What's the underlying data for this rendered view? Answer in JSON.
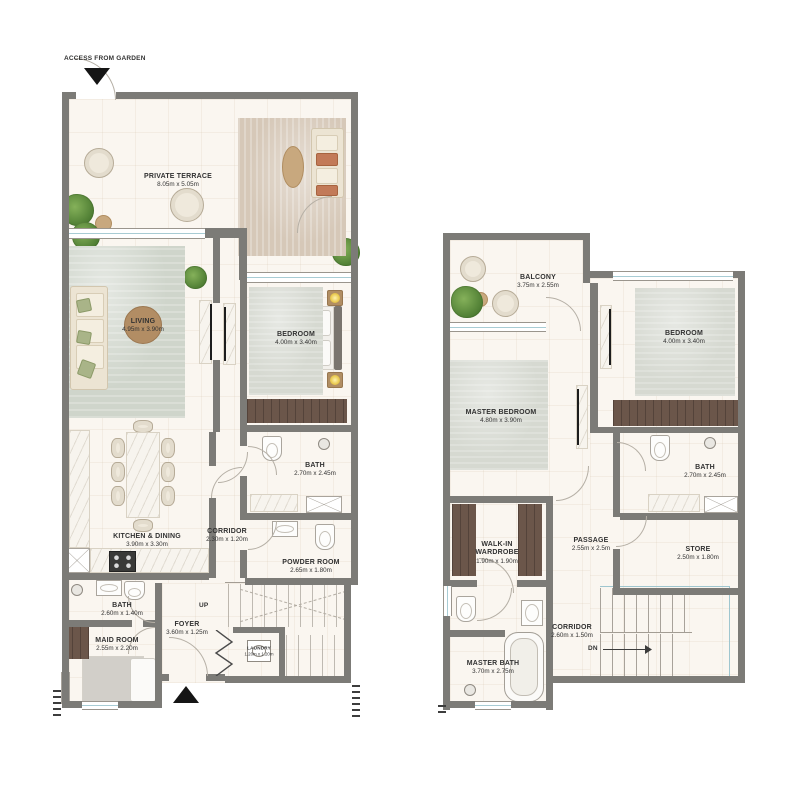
{
  "floor1": {
    "access_label": "ACCESS FROM GARDEN",
    "up_label": "UP",
    "rooms": {
      "terrace": {
        "name": "PRIVATE TERRACE",
        "dims": "8.05m x 5.05m"
      },
      "living": {
        "name": "LIVING",
        "dims": "4.95m x 3.90m"
      },
      "bedroom": {
        "name": "BEDROOM",
        "dims": "4.00m x 3.40m"
      },
      "bath": {
        "name": "BATH",
        "dims": "2.70m x 2.45m"
      },
      "corridor": {
        "name": "CORRIDOR",
        "dims": "2.30m x 1.20m"
      },
      "kitchen": {
        "name": "KITCHEN & DINING",
        "dims": "3.90m x 3.30m"
      },
      "powder": {
        "name": "POWDER ROOM",
        "dims": "2.65m x 1.80m"
      },
      "bath2": {
        "name": "BATH",
        "dims": "2.60m x 1.40m"
      },
      "maid": {
        "name": "MAID ROOM",
        "dims": "2.55m x 2.20m"
      },
      "foyer": {
        "name": "FOYER",
        "dims": "3.60m x 1.25m"
      },
      "laundry": {
        "name": "LAUNDRY",
        "dims": "1.20m x 1.20m"
      }
    }
  },
  "floor2": {
    "dn_label": "DN",
    "rooms": {
      "balcony": {
        "name": "BALCONY",
        "dims": "3.75m x 2.55m"
      },
      "bedroom": {
        "name": "BEDROOM",
        "dims": "4.00m x 3.40m"
      },
      "master": {
        "name": "MASTER BEDROOM",
        "dims": "4.80m x 3.90m"
      },
      "bath": {
        "name": "BATH",
        "dims": "2.70m x 2.45m"
      },
      "wardrobe": {
        "name": "WALK-IN WARDROBE",
        "dims": "1.90m x 1.90m"
      },
      "passage": {
        "name": "PASSAGE",
        "dims": "2.55m x 2.5m"
      },
      "store": {
        "name": "STORE",
        "dims": "2.50m x 1.80m"
      },
      "corridor": {
        "name": "CORRIDOR",
        "dims": "2.60m x 1.50m"
      },
      "master_bath": {
        "name": "MASTER BATH",
        "dims": "3.70m x 2.75m"
      }
    }
  },
  "colors": {
    "wall": "#7c7b77",
    "floor": "#faf6f0",
    "accent_green": "#a6b183",
    "wood": "#b28d64",
    "dark_wood": "#6b564a",
    "glass": "#a8ccd4"
  }
}
